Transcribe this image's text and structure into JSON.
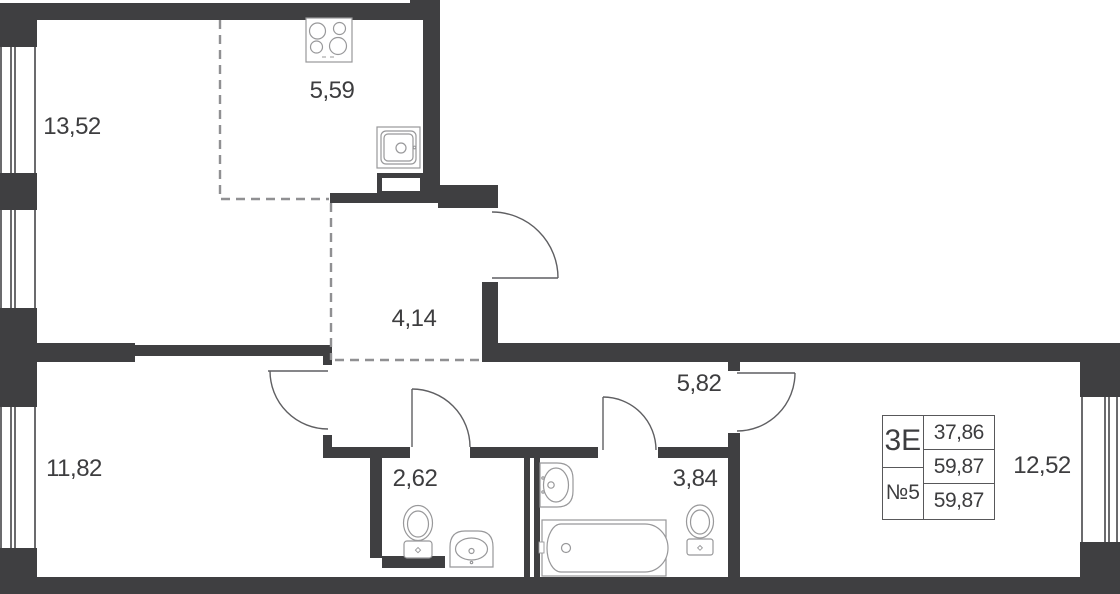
{
  "rooms": [
    {
      "key": "living",
      "area": "13,52"
    },
    {
      "key": "kitchen",
      "area": "5,59"
    },
    {
      "key": "hallway",
      "area": "4,14"
    },
    {
      "key": "bedroom1",
      "area": "11,82"
    },
    {
      "key": "wc",
      "area": "2,62"
    },
    {
      "key": "bathroom",
      "area": "3,84"
    },
    {
      "key": "corridor",
      "area": "5,82"
    },
    {
      "key": "bedroom2",
      "area": "12,52"
    }
  ],
  "info_table": {
    "layout_type": "3Е",
    "unit_number": "№5",
    "rows": [
      "37,86",
      "59,87",
      "59,87"
    ]
  },
  "colors": {
    "wall": "#3f3f41",
    "fixture_line": "#98989a",
    "door_line": "#5f5f62",
    "dashed_line": "#909092",
    "text": "#3d3d3f",
    "table_border": "#58585a",
    "background": "#ffffff"
  }
}
